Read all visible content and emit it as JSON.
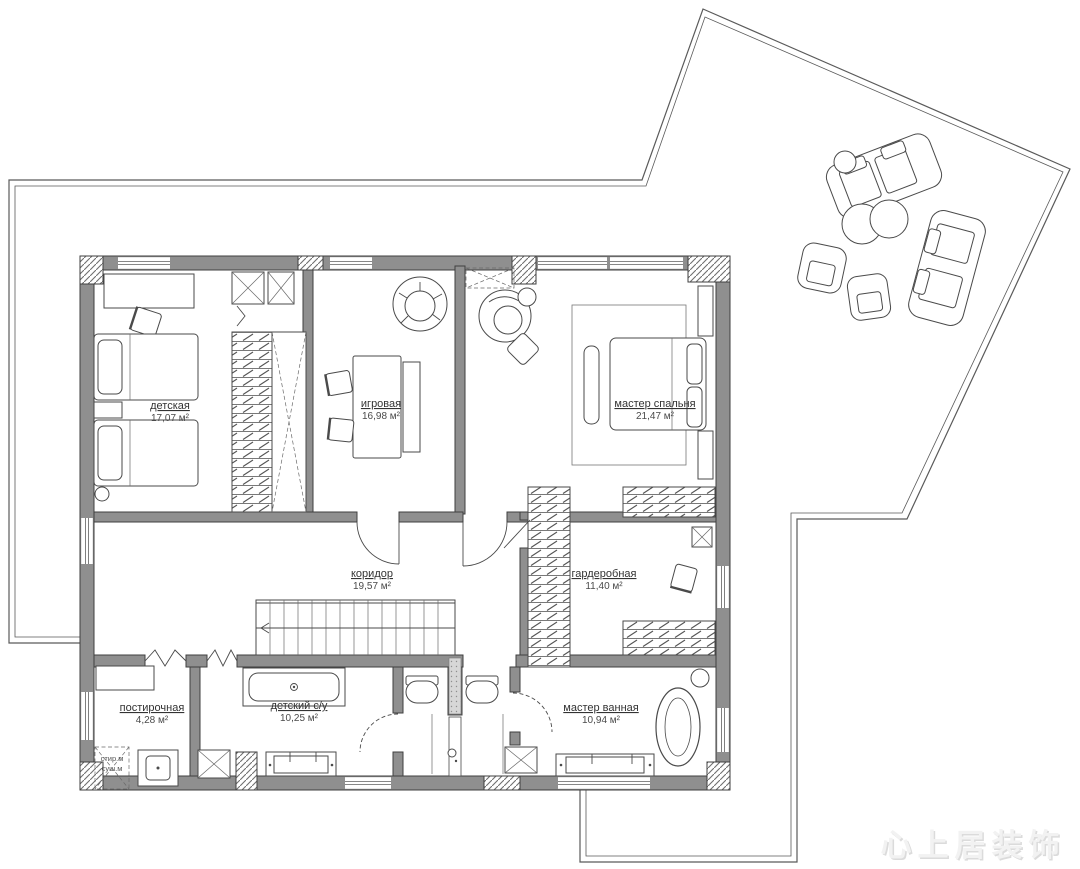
{
  "colors": {
    "wall": "#8f8f8f",
    "outline": "#3f3f3f",
    "background": "#ffffff",
    "watermark": "#e0e0e0"
  },
  "rooms": [
    {
      "name": "детская",
      "area": "17,07 м²"
    },
    {
      "name": "игровая",
      "area": "16,98 м²"
    },
    {
      "name": "мастер спальня",
      "area": "21,47 м²"
    },
    {
      "name": "коридор",
      "area": "19,57 м²"
    },
    {
      "name": "гардеробная",
      "area": "11,40 м²"
    },
    {
      "name": "постирочная",
      "area": "4,28 м²"
    },
    {
      "name": "детский с/у",
      "area": "10,25 м²"
    },
    {
      "name": "мастер ванная",
      "area": "10,94 м²"
    }
  ],
  "appliances": {
    "washer": "стир.м",
    "dryer": "суш.м"
  },
  "watermark": "心上居装饰"
}
